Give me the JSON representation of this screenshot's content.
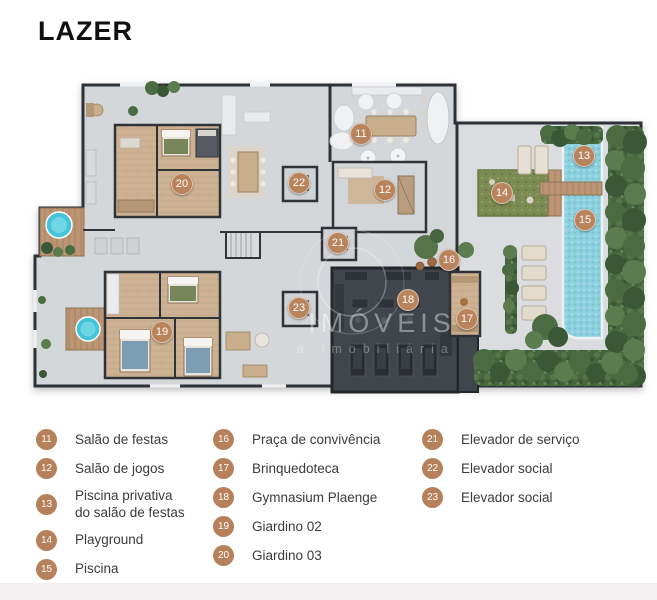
{
  "page": {
    "title": "LAZER"
  },
  "watermark": {
    "line1": "IMÓVEIS",
    "line2": "a imobiliária"
  },
  "colors": {
    "accent": "#B9835C",
    "wall": "#2F3338",
    "floor": "#D3D6D9",
    "wood": "#CDB394",
    "deck": "#C2A181",
    "pool": "#8CCFDD",
    "hedge": "#47663F",
    "playground": "#7B8B51",
    "gym": "#41464D"
  },
  "plan": {
    "markers": [
      {
        "num": "11",
        "x": 361,
        "y": 134
      },
      {
        "num": "12",
        "x": 385,
        "y": 190
      },
      {
        "num": "13",
        "x": 584,
        "y": 156
      },
      {
        "num": "14",
        "x": 502,
        "y": 193
      },
      {
        "num": "15",
        "x": 585,
        "y": 220
      },
      {
        "num": "16",
        "x": 449,
        "y": 260
      },
      {
        "num": "17",
        "x": 467,
        "y": 319
      },
      {
        "num": "18",
        "x": 408,
        "y": 300
      },
      {
        "num": "19",
        "x": 162,
        "y": 332
      },
      {
        "num": "20",
        "x": 182,
        "y": 184
      },
      {
        "num": "21",
        "x": 338,
        "y": 243
      },
      {
        "num": "22",
        "x": 299,
        "y": 183
      },
      {
        "num": "23",
        "x": 299,
        "y": 308
      }
    ]
  },
  "legend": {
    "columns": [
      [
        {
          "num": "11",
          "label": "Salão de festas"
        },
        {
          "num": "12",
          "label": "Salão de jogos"
        },
        {
          "num": "13",
          "label": "Piscina privativa do salão de festas"
        },
        {
          "num": "14",
          "label": "Playground"
        },
        {
          "num": "15",
          "label": "Piscina"
        }
      ],
      [
        {
          "num": "16",
          "label": "Praça de convivência"
        },
        {
          "num": "17",
          "label": "Brinquedoteca"
        },
        {
          "num": "18",
          "label": "Gymnasium Plaenge"
        },
        {
          "num": "19",
          "label": "Giardino 02"
        },
        {
          "num": "20",
          "label": "Giardino 03"
        }
      ],
      [
        {
          "num": "21",
          "label": "Elevador de serviço"
        },
        {
          "num": "22",
          "label": "Elevador social"
        },
        {
          "num": "23",
          "label": "Elevador social"
        }
      ]
    ]
  }
}
